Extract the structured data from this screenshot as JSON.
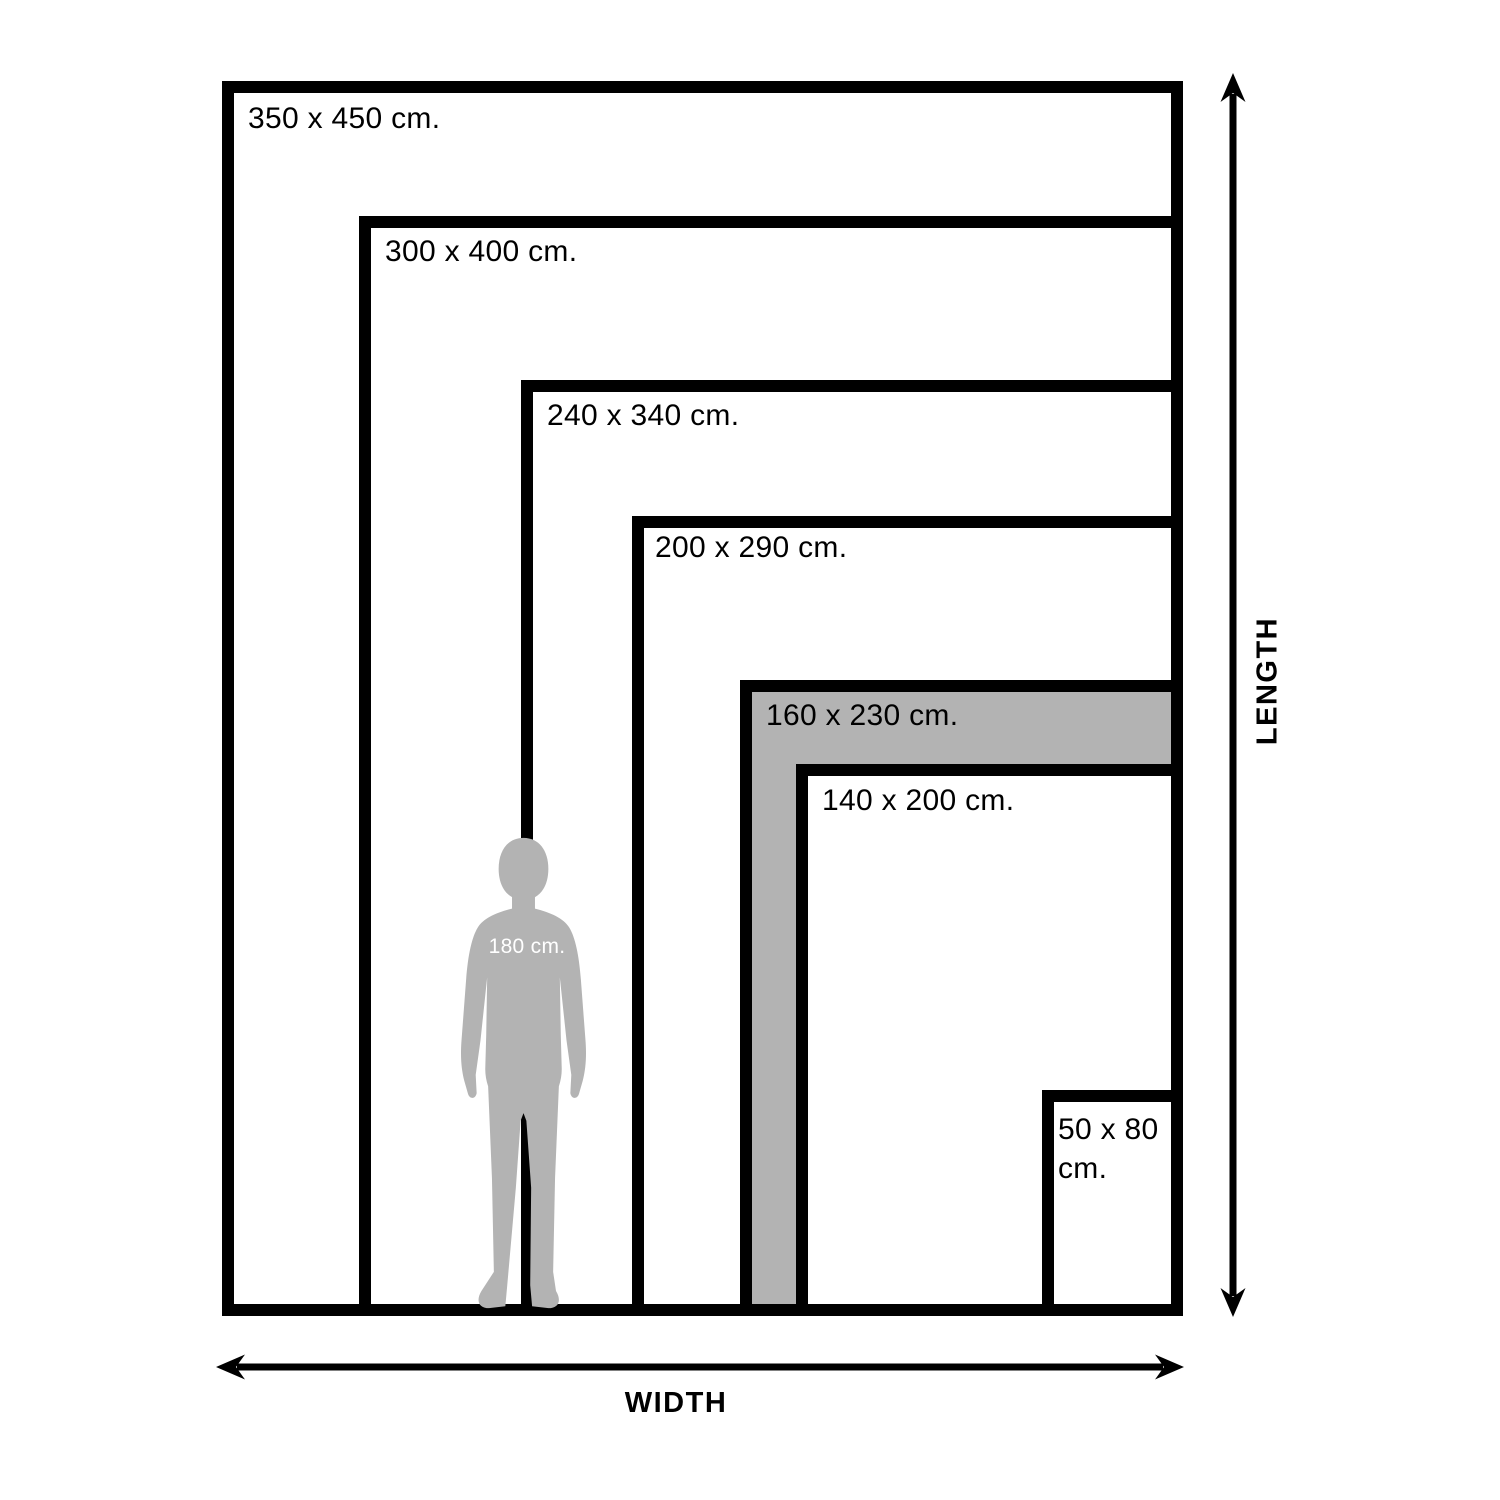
{
  "diagram": {
    "type": "rug-size-comparison",
    "background": "#ffffff"
  },
  "sizes": [
    {
      "label": "350 x 450 cm.",
      "width_cm": 350,
      "length_cm": 450,
      "highlighted": false
    },
    {
      "label": "300 x 400 cm.",
      "width_cm": 300,
      "length_cm": 400,
      "highlighted": false
    },
    {
      "label": "240 x 340 cm.",
      "width_cm": 240,
      "length_cm": 340,
      "highlighted": false
    },
    {
      "label": "200 x 290 cm.",
      "width_cm": 200,
      "length_cm": 290,
      "highlighted": false
    },
    {
      "label": "160 x 230 cm.",
      "width_cm": 160,
      "length_cm": 230,
      "highlighted": true
    },
    {
      "label": "140 x 200 cm.",
      "width_cm": 140,
      "length_cm": 200,
      "highlighted": false
    },
    {
      "label": "50 x 80 cm.",
      "width_cm": 50,
      "length_cm": 80,
      "highlighted": false
    }
  ],
  "person": {
    "label": "180 cm.",
    "height_cm": 180
  },
  "axes": {
    "width_label": "WIDTH",
    "length_label": "LENGTH"
  },
  "colors": {
    "line": "#000000",
    "text": "#000000",
    "highlight_fill": "#b3b3b3",
    "person_fill": "#b3b3b3",
    "person_label": "#ffffff",
    "background": "#ffffff"
  }
}
